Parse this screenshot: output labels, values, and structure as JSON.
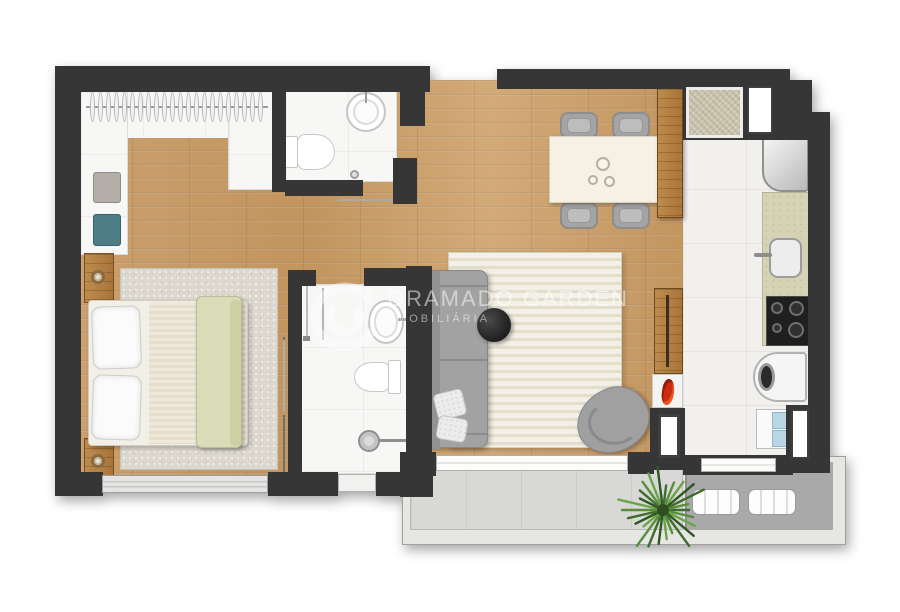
{
  "watermark": {
    "line1": "GRAMADO GARDEN",
    "line2": "IMOBILIÁRIA"
  },
  "palette": {
    "wall": "#363636",
    "wood_floor": "#c99e6b",
    "white_room_floor": "#f7f7f6",
    "kitchen_tile": "#f1f0ed",
    "counter_beige": "#d6d2b5",
    "rug_living_cream": "#eae4d3",
    "rug_bedroom_gray": "#dcd8cf",
    "sofa_gray": "#a2a2a2",
    "blanket_green": "#d9dcb6",
    "cabinet_glass_blue": "#b9d6e4",
    "flowers_red": "#cc2d12",
    "balcony_light": "#d8d8d6",
    "balcony_dark": "#a9a9a9",
    "plant_green": "#4c7a38",
    "watermark_white": "rgba(255,255,255,0.5)"
  }
}
